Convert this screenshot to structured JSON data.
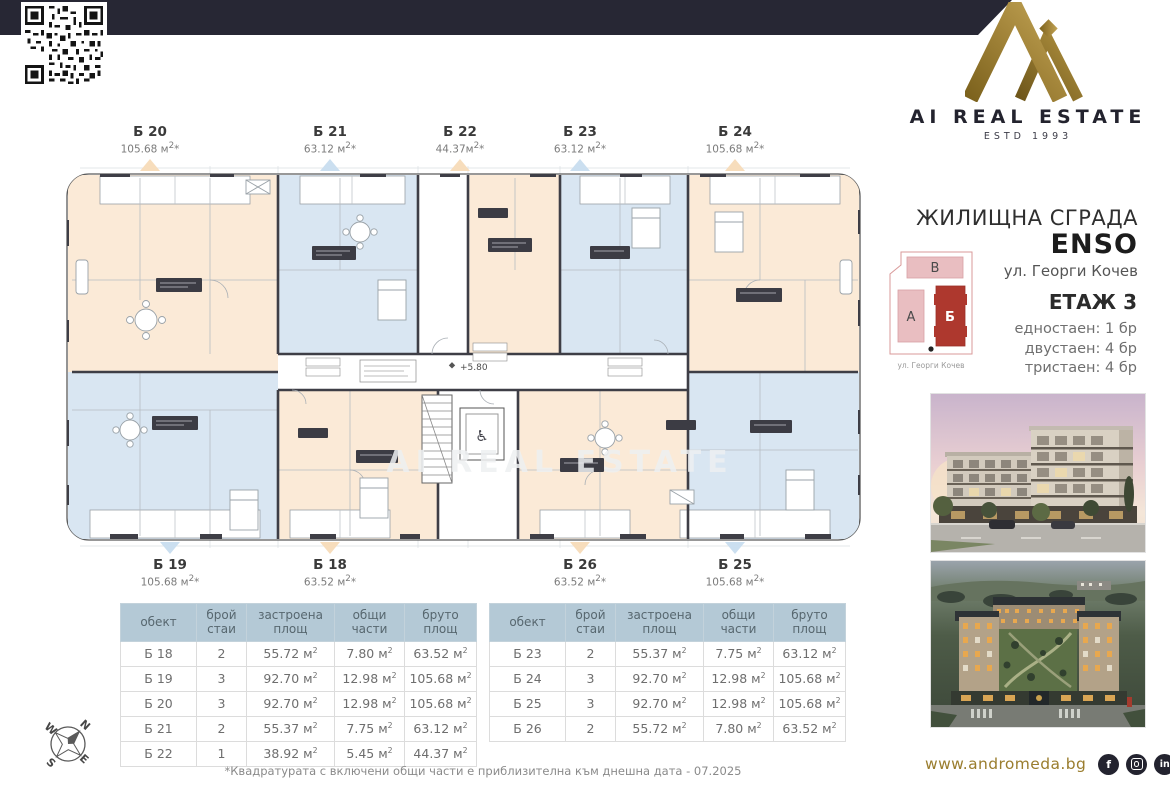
{
  "banner": {
    "text": "ЕКСКЛУЗИВНО ОТ"
  },
  "brand": {
    "name": "AI REAL ESTATE",
    "estd": "ESTD 1993"
  },
  "project": {
    "type": "ЖИЛИЩНА СГРАДА",
    "name": "ENSO",
    "address": "ул. Георги Кочев"
  },
  "site_plan": {
    "building_v": "В",
    "building_a": "А",
    "building_b": "Б",
    "street": "ул. Георги Кочев"
  },
  "floor": {
    "title": "ЕТАЖ 3",
    "mix": [
      "едностаен: 1 бр",
      "двустаен: 4 бр",
      "тристаен: 4 бр"
    ]
  },
  "plan": {
    "elevation": "+5.80",
    "watermark": "AI REAL ESTATE",
    "top_units": [
      {
        "label": "Б 20",
        "area": "105.68 м²*",
        "color": "peach"
      },
      {
        "label": "Б 21",
        "area": "63.12 м²*",
        "color": "blue"
      },
      {
        "label": "Б 22",
        "area": "44.37м²*",
        "color": "peach"
      },
      {
        "label": "Б 23",
        "area": "63.12 м²*",
        "color": "blue"
      },
      {
        "label": "Б 24",
        "area": "105.68 м²*",
        "color": "peach"
      }
    ],
    "bottom_units": [
      {
        "label": "Б 19",
        "area": "105.68 м²*",
        "color": "blue"
      },
      {
        "label": "Б 18",
        "area": "63.52 м²*",
        "color": "peach"
      },
      {
        "label": "Б 26",
        "area": "63.52 м²*",
        "color": "peach"
      },
      {
        "label": "Б 25",
        "area": "105.68 м²*",
        "color": "blue"
      }
    ]
  },
  "tables": {
    "headers": [
      "обект",
      "брой стаи",
      "застроена площ",
      "общи части",
      "бруто площ"
    ],
    "left_rows": [
      [
        "Б 18",
        "2",
        "55.72 м²",
        "7.80 м²",
        "63.52 м²"
      ],
      [
        "Б 19",
        "3",
        "92.70 м²",
        "12.98 м²",
        "105.68 м²"
      ],
      [
        "Б 20",
        "3",
        "92.70 м²",
        "12.98 м²",
        "105.68 м²"
      ],
      [
        "Б 21",
        "2",
        "55.37 м²",
        "7.75 м²",
        "63.12 м²"
      ],
      [
        "Б 22",
        "1",
        "38.92 м²",
        "5.45 м²",
        "44.37 м²"
      ]
    ],
    "right_rows": [
      [
        "Б 23",
        "2",
        "55.37 м²",
        "7.75 м²",
        "63.12 м²"
      ],
      [
        "Б 24",
        "3",
        "92.70 м²",
        "12.98 м²",
        "105.68 м²"
      ],
      [
        "Б 25",
        "3",
        "92.70 м²",
        "12.98 м²",
        "105.68 м²"
      ],
      [
        "Б 26",
        "2",
        "55.72 м²",
        "7.80 м²",
        "63.52 м²"
      ]
    ]
  },
  "footnote": "*Квадратурата с включени общи части е приблизителна към днешна дата - 07.2025",
  "footer": {
    "website": "www.andromeda.bg",
    "social": [
      {
        "id": "facebook",
        "glyph": "f"
      },
      {
        "id": "instagram",
        "glyph": ""
      },
      {
        "id": "linkedin",
        "glyph": "in"
      }
    ]
  },
  "compass": {
    "n": "N",
    "e": "E",
    "s": "S",
    "w": "W"
  },
  "colors": {
    "navy": "#272734",
    "gold": "#9a7d2e",
    "peach_room": "#fbead7",
    "blue_room": "#d9e6f2",
    "site_red": "#ae382e",
    "site_pink": "#e9bec1",
    "table_header": "#b4c9d6"
  }
}
